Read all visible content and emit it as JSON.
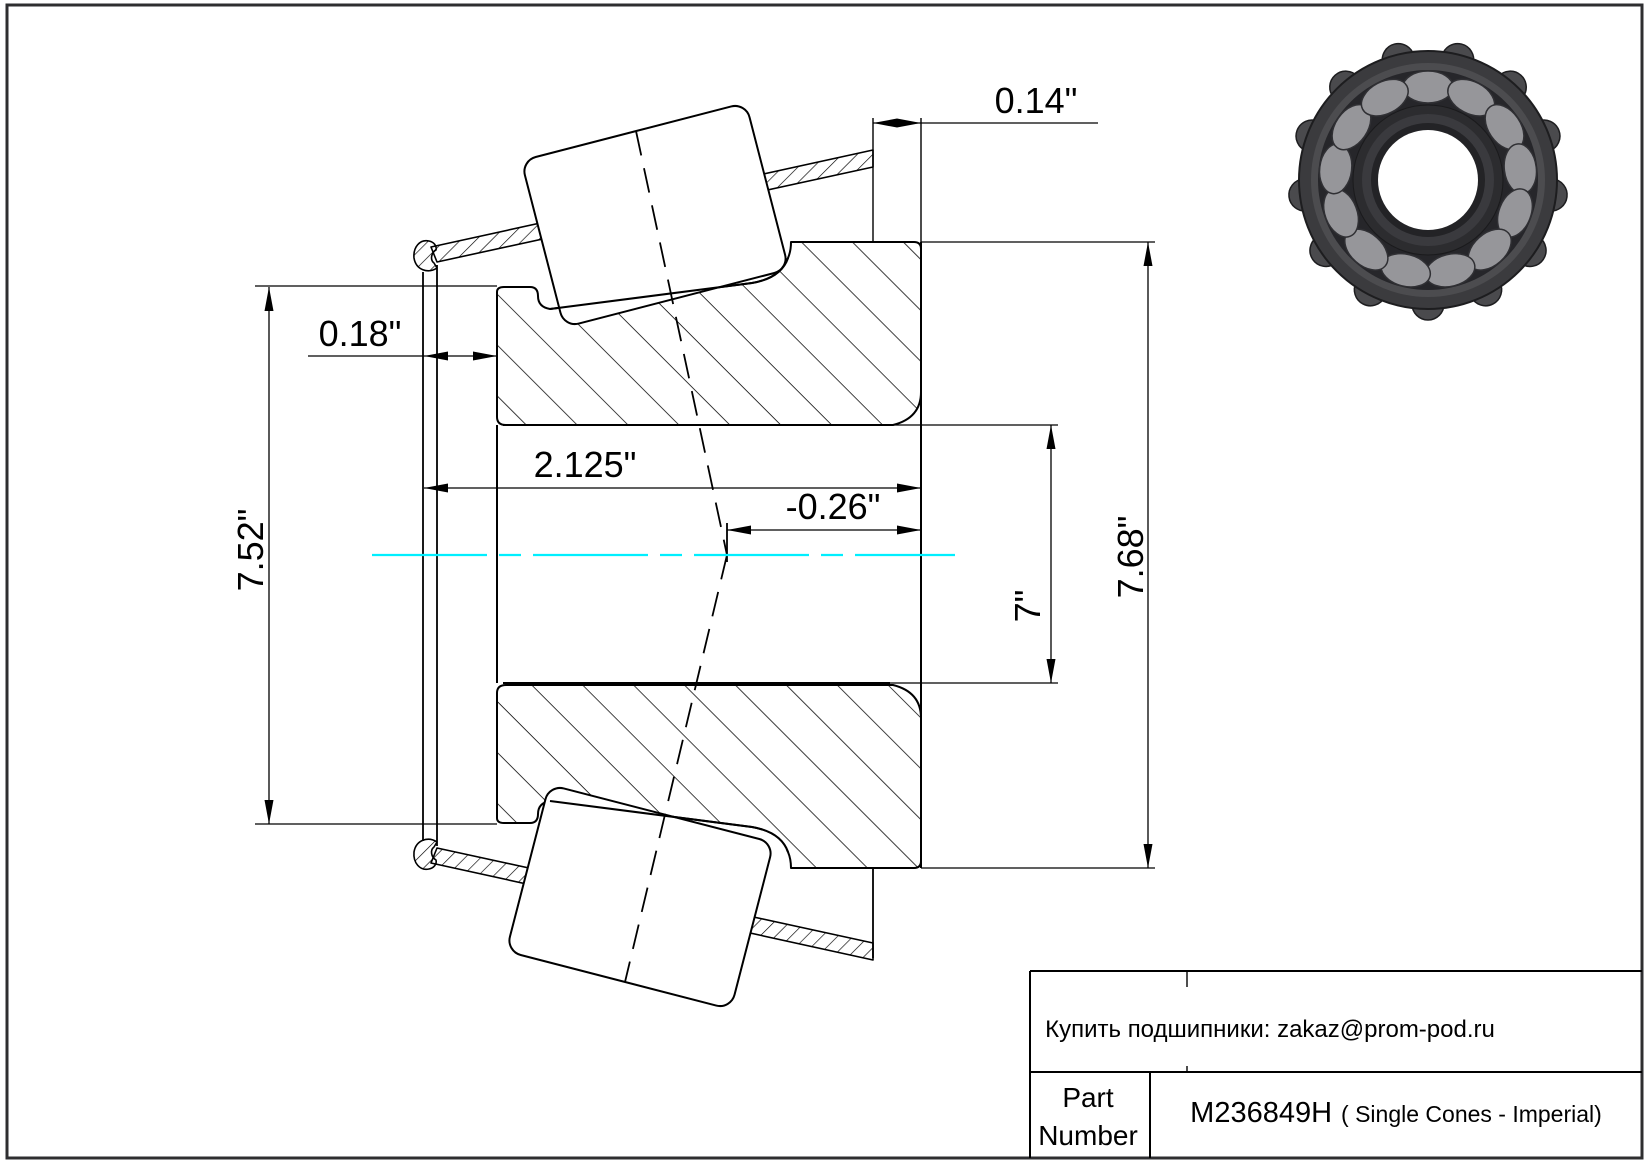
{
  "page": {
    "background": "#ffffff",
    "border_color": "#2e2e30"
  },
  "drawing": {
    "centerline_color": "#00EFFF",
    "dimensions": {
      "back_face_offset": "0.14\"",
      "front_face_offset": "0.18\"",
      "cone_width": "2.125\"",
      "effective_center_offset": "-0.26\"",
      "bore_diameter": "7\"",
      "cage_rib_diameter": "7.52\"",
      "outer_diameter": "7.68\""
    }
  },
  "title_block": {
    "purchase_note": "Купить подшипники: zakaz@prom-pod.ru",
    "part_label_line1": "Part",
    "part_label_line2": "Number",
    "part_number": "M236849H",
    "part_series": "( Single Cones - Imperial)"
  }
}
